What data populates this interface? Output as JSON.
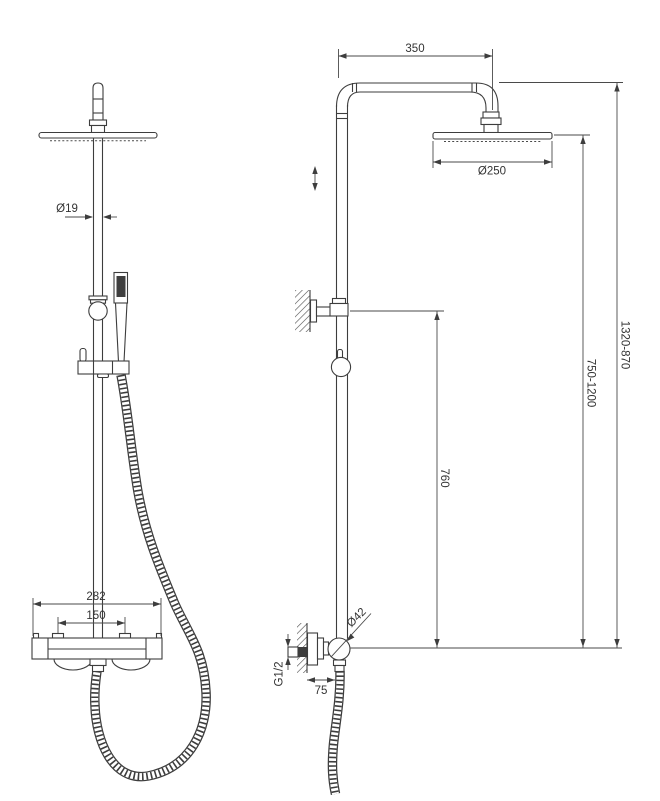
{
  "drawing": {
    "subject": "shower-column-technical-drawing",
    "colors": {
      "line": "#3d3d3d",
      "text": "#333333",
      "background": "#ffffff"
    }
  },
  "labels": {
    "pipe_diameter": "Ø19",
    "valve_width": "282",
    "inlet_spacing": "150",
    "arm_length": "350",
    "head_diameter": "Ø250",
    "overall_height": "1320-870",
    "riser_range": "750-1200",
    "bracket_height": "760",
    "connector_diameter": "Ø42",
    "thread_size": "G1/2",
    "wall_offset": "75"
  }
}
